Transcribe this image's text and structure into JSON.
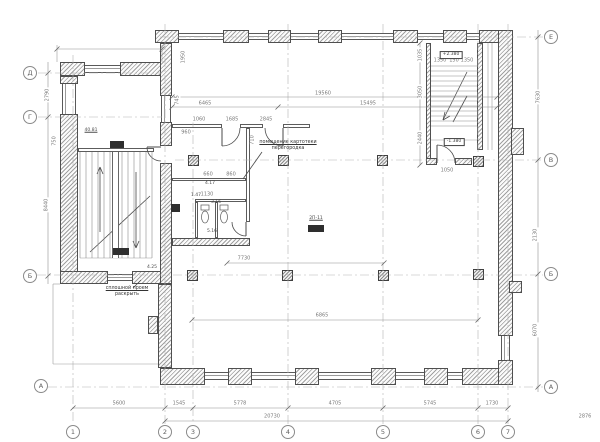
{
  "drawing_type": "architectural floor plan",
  "annotations": {
    "callout": {
      "line1": "помещение картотеки",
      "line2": "перегородка"
    },
    "opening_note": {
      "line1": "сплошной проем",
      "line2": "раскрыть"
    }
  },
  "colors": {
    "wall_line": "#4f4f4f",
    "hatch": "#a0a0a0",
    "dim_line": "#8f8f8f",
    "axis_line": "#b3b3b3",
    "dim_text": "#7a7a7a",
    "stamp": "#2e2e2e"
  },
  "plan": {
    "bubbles": [
      {
        "label": "Д",
        "x": 30,
        "y": 73
      },
      {
        "label": "Г",
        "x": 30,
        "y": 117
      },
      {
        "label": "Б",
        "x": 30,
        "y": 276
      },
      {
        "label": "А",
        "x": 41,
        "y": 386
      },
      {
        "label": "Е",
        "x": 551,
        "y": 37
      },
      {
        "label": "В",
        "x": 551,
        "y": 160
      },
      {
        "label": "Б",
        "x": 551,
        "y": 274
      },
      {
        "label": "А",
        "x": 551,
        "y": 387
      },
      {
        "label": "1",
        "x": 73,
        "y": 432
      },
      {
        "label": "2",
        "x": 165,
        "y": 432
      },
      {
        "label": "3",
        "x": 193,
        "y": 432
      },
      {
        "label": "4",
        "x": 288,
        "y": 432
      },
      {
        "label": "5",
        "x": 383,
        "y": 432
      },
      {
        "label": "6",
        "x": 478,
        "y": 432
      },
      {
        "label": "7",
        "x": 508,
        "y": 432
      }
    ],
    "walls": [
      [
        155,
        30,
        24,
        13
      ],
      [
        223,
        30,
        26,
        13
      ],
      [
        268,
        30,
        23,
        13
      ],
      [
        318,
        30,
        24,
        13
      ],
      [
        393,
        30,
        25,
        13
      ],
      [
        443,
        30,
        24,
        13
      ],
      [
        479,
        30,
        34,
        13
      ],
      [
        60,
        62,
        25,
        14
      ],
      [
        120,
        62,
        42,
        14
      ],
      [
        60,
        76,
        18,
        8
      ],
      [
        60,
        114,
        18,
        170
      ],
      [
        60,
        271,
        48,
        13
      ],
      [
        132,
        271,
        40,
        13
      ],
      [
        160,
        43,
        12,
        53
      ],
      [
        160,
        122,
        12,
        24
      ],
      [
        160,
        163,
        12,
        121
      ],
      [
        158,
        284,
        14,
        84
      ],
      [
        148,
        316,
        10,
        18
      ],
      [
        160,
        368,
        45,
        17
      ],
      [
        228,
        368,
        24,
        17
      ],
      [
        295,
        368,
        24,
        17
      ],
      [
        371,
        368,
        25,
        17
      ],
      [
        424,
        368,
        24,
        17
      ],
      [
        462,
        368,
        51,
        17
      ],
      [
        498,
        30,
        15,
        306
      ],
      [
        498,
        360,
        15,
        25
      ],
      [
        511,
        128,
        13,
        27
      ],
      [
        509,
        281,
        13,
        12
      ],
      [
        426,
        43,
        5,
        122
      ],
      [
        477,
        43,
        6,
        107
      ],
      [
        426,
        158,
        11,
        7
      ],
      [
        455,
        158,
        17,
        7
      ],
      [
        172,
        238,
        78,
        8
      ]
    ],
    "windows": [
      [
        179,
        33,
        44,
        7,
        "h"
      ],
      [
        249,
        33,
        19,
        7,
        "h"
      ],
      [
        291,
        33,
        27,
        7,
        "h"
      ],
      [
        342,
        33,
        51,
        7,
        "h"
      ],
      [
        418,
        33,
        25,
        7,
        "h"
      ],
      [
        467,
        33,
        12,
        7,
        "h"
      ],
      [
        85,
        65,
        35,
        8,
        "h"
      ],
      [
        62,
        84,
        14,
        30,
        "v"
      ],
      [
        161,
        96,
        10,
        26,
        "v"
      ],
      [
        108,
        274,
        24,
        7,
        "h"
      ],
      [
        205,
        372,
        23,
        8,
        "h"
      ],
      [
        252,
        372,
        43,
        8,
        "h"
      ],
      [
        319,
        372,
        52,
        8,
        "h"
      ],
      [
        396,
        372,
        28,
        8,
        "h"
      ],
      [
        448,
        372,
        14,
        8,
        "h"
      ],
      [
        501,
        336,
        9,
        24,
        "v"
      ]
    ],
    "partitions": [
      [
        172,
        124,
        50,
        4
      ],
      [
        240,
        124,
        23,
        4
      ],
      [
        283,
        124,
        27,
        4
      ],
      [
        246,
        128,
        4,
        94
      ],
      [
        172,
        178,
        74,
        3
      ],
      [
        195,
        199,
        51,
        3
      ],
      [
        215,
        202,
        3,
        36
      ],
      [
        195,
        202,
        3,
        36
      ],
      [
        78,
        148,
        76,
        4
      ]
    ],
    "columns": [
      [
        193,
        160
      ],
      [
        283,
        160
      ],
      [
        382,
        160
      ],
      [
        478,
        161
      ],
      [
        192,
        275
      ],
      [
        287,
        275
      ],
      [
        383,
        275
      ],
      [
        478,
        274
      ]
    ],
    "stamps": [
      [
        110,
        141,
        14,
        7
      ],
      [
        113,
        248,
        16,
        7
      ],
      [
        308,
        225,
        16,
        7
      ],
      [
        171,
        204,
        9,
        8
      ]
    ],
    "bands": [
      [
        112,
        152,
        7,
        106
      ]
    ],
    "level_labels": [
      {
        "t": "+2.380",
        "x": 451,
        "y": 55
      },
      {
        "t": "-1.380",
        "x": 454,
        "y": 142
      }
    ],
    "room_tags": [
      {
        "t": "40.81",
        "x": 91,
        "y": 131,
        "u": true
      },
      {
        "t": "2П-11",
        "x": 316,
        "y": 219,
        "u": true
      },
      {
        "t": "4.17",
        "x": 210,
        "y": 184,
        "u": false
      },
      {
        "t": "3.16",
        "x": 216,
        "y": 203,
        "u": false
      },
      {
        "t": "5.16",
        "x": 212,
        "y": 232,
        "u": false
      },
      {
        "t": "1.47",
        "x": 196,
        "y": 196,
        "u": false
      },
      {
        "t": "4.25",
        "x": 152,
        "y": 268,
        "u": false
      }
    ],
    "dim_texts": [
      {
        "t": "19560",
        "x": 323,
        "y": 94,
        "r": 0
      },
      {
        "t": "6465",
        "x": 205,
        "y": 104,
        "r": 0
      },
      {
        "t": "15495",
        "x": 368,
        "y": 104,
        "r": 0
      },
      {
        "t": "1950",
        "x": 184,
        "y": 57,
        "r": -90
      },
      {
        "t": "745",
        "x": 178,
        "y": 100,
        "r": -90
      },
      {
        "t": "2790",
        "x": 48,
        "y": 95,
        "r": -90
      },
      {
        "t": "750",
        "x": 55,
        "y": 141,
        "r": -90
      },
      {
        "t": "8440",
        "x": 47,
        "y": 205,
        "r": -90
      },
      {
        "t": "7630",
        "x": 539,
        "y": 97,
        "r": -90
      },
      {
        "t": "2130",
        "x": 536,
        "y": 235,
        "r": -90
      },
      {
        "t": "6070",
        "x": 536,
        "y": 330,
        "r": -90
      },
      {
        "t": "5600",
        "x": 119,
        "y": 404,
        "r": 0
      },
      {
        "t": "1545",
        "x": 179,
        "y": 404,
        "r": 0
      },
      {
        "t": "5778",
        "x": 240,
        "y": 404,
        "r": 0
      },
      {
        "t": "4705",
        "x": 335,
        "y": 404,
        "r": 0
      },
      {
        "t": "5745",
        "x": 430,
        "y": 404,
        "r": 0
      },
      {
        "t": "1730",
        "x": 492,
        "y": 404,
        "r": 0
      },
      {
        "t": "20730",
        "x": 272,
        "y": 417,
        "r": 0
      },
      {
        "t": "2876",
        "x": 585,
        "y": 417,
        "r": 0
      },
      {
        "t": "7730",
        "x": 244,
        "y": 259,
        "r": 0
      },
      {
        "t": "6865",
        "x": 322,
        "y": 316,
        "r": 0
      },
      {
        "t": "1350",
        "x": 440,
        "y": 61,
        "r": 0
      },
      {
        "t": "150",
        "x": 454,
        "y": 61,
        "r": 0
      },
      {
        "t": "1350",
        "x": 467,
        "y": 61,
        "r": 0
      },
      {
        "t": "1035",
        "x": 421,
        "y": 55,
        "r": -90
      },
      {
        "t": "3050",
        "x": 421,
        "y": 92,
        "r": -90
      },
      {
        "t": "2440",
        "x": 421,
        "y": 138,
        "r": -90
      },
      {
        "t": "1050",
        "x": 447,
        "y": 171,
        "r": 0
      },
      {
        "t": "960",
        "x": 186,
        "y": 133,
        "r": 0
      },
      {
        "t": "1060",
        "x": 199,
        "y": 120,
        "r": 0
      },
      {
        "t": "1685",
        "x": 232,
        "y": 120,
        "r": 0
      },
      {
        "t": "2845",
        "x": 266,
        "y": 120,
        "r": 0
      },
      {
        "t": "660",
        "x": 208,
        "y": 175,
        "r": 0
      },
      {
        "t": "860",
        "x": 231,
        "y": 175,
        "r": 0
      },
      {
        "t": "1130",
        "x": 207,
        "y": 195,
        "r": 0
      },
      {
        "t": "710",
        "x": 253,
        "y": 140,
        "r": -90
      }
    ],
    "svg": {
      "axis": [
        [
          73,
          55,
          73,
          424
        ],
        [
          165,
          24,
          165,
          424
        ],
        [
          193,
          118,
          193,
          424
        ],
        [
          288,
          24,
          288,
          424
        ],
        [
          383,
          24,
          383,
          424
        ],
        [
          478,
          24,
          478,
          424
        ],
        [
          508,
          24,
          508,
          424
        ],
        [
          160,
          37,
          543,
          37
        ],
        [
          38,
          73,
          162,
          73
        ],
        [
          38,
          117,
          162,
          117
        ],
        [
          175,
          160,
          543,
          160
        ],
        [
          37,
          275,
          543,
          275
        ],
        [
          48,
          387,
          543,
          387
        ]
      ],
      "dim": [
        [
          172,
          97,
          497,
          97
        ],
        [
          172,
          107,
          497,
          107
        ],
        [
          73,
          408,
          508,
          408
        ],
        [
          165,
          421,
          508,
          421
        ],
        [
          48,
          62,
          48,
          284
        ],
        [
          538,
          30,
          538,
          392
        ],
        [
          227,
          263,
          384,
          263
        ],
        [
          192,
          320,
          478,
          320
        ],
        [
          57,
          49,
          162,
          49
        ],
        [
          420,
          43,
          420,
          165
        ]
      ],
      "thin": [
        [
          53,
          284,
          53,
          364
        ],
        [
          53,
          364,
          158,
          364
        ],
        [
          53,
          284,
          60,
          284
        ],
        [
          488,
          43,
          488,
          150
        ],
        [
          492,
          43,
          492,
          150
        ],
        [
          57,
          45,
          57,
          62
        ],
        [
          162,
          45,
          162,
          62
        ],
        [
          431,
          140,
          477,
          140
        ],
        [
          80,
          258,
          152,
          258
        ]
      ],
      "lead": [
        [
          262,
          152,
          243,
          179
        ],
        [
          133,
          288,
          141,
          280
        ],
        [
          100,
          232,
          100,
          167
        ],
        [
          97,
          174,
          100,
          167
        ],
        [
          103,
          174,
          100,
          167
        ],
        [
          136,
          172,
          136,
          248
        ],
        [
          133,
          241,
          136,
          248
        ],
        [
          139,
          241,
          136,
          248
        ],
        [
          90,
          252,
          150,
          196
        ],
        [
          467,
          72,
          443,
          120
        ],
        [
          445,
          112,
          443,
          120
        ],
        [
          450,
          116,
          443,
          120
        ],
        [
          467,
          96,
          453,
          122
        ]
      ],
      "ticks": [
        [
          73,
          408
        ],
        [
          165,
          408
        ],
        [
          193,
          408
        ],
        [
          288,
          408
        ],
        [
          383,
          408
        ],
        [
          478,
          408
        ],
        [
          508,
          408
        ],
        [
          165,
          421
        ],
        [
          508,
          421
        ],
        [
          172,
          97
        ],
        [
          497,
          97
        ],
        [
          172,
          107
        ],
        [
          278,
          107
        ],
        [
          497,
          107
        ],
        [
          227,
          263
        ],
        [
          384,
          263
        ],
        [
          192,
          320
        ],
        [
          478,
          320
        ],
        [
          57,
          49
        ],
        [
          162,
          49
        ],
        [
          48,
          73
        ],
        [
          48,
          117
        ],
        [
          48,
          276
        ],
        [
          538,
          37
        ],
        [
          538,
          160
        ],
        [
          538,
          274
        ],
        [
          538,
          387
        ],
        [
          420,
          43
        ],
        [
          420,
          165
        ]
      ],
      "arcs": [
        "M240,128 A18,18 0 0 1 222,146",
        "M265,128 A18,18 0 0 0 283,146",
        "M232,222 A14,14 0 0 0 246,236",
        "M437,145 A18,18 0 0 1 455,163",
        "M147,147 A14,14 0 0 0 161,161"
      ],
      "leafs": [
        [
          222,
          128,
          222,
          146
        ],
        [
          283,
          128,
          283,
          146
        ],
        [
          246,
          222,
          246,
          236
        ],
        [
          437,
          163,
          437,
          145
        ],
        [
          161,
          147,
          147,
          147
        ]
      ],
      "treads": [
        {
          "orient": "v",
          "from": 80,
          "to": 152,
          "step": 6,
          "a": 152,
          "b": 258
        },
        {
          "orient": "h",
          "from": 66,
          "to": 130,
          "step": 5,
          "a": 431,
          "b": 477
        }
      ],
      "fixtures": {
        "toilets": [
          {
            "tank": [
              201,
              205,
              8,
              5
            ],
            "bowl": [
              205,
              217,
              3.5,
              6
            ]
          },
          {
            "tank": [
              220,
              205,
              8,
              5
            ],
            "bowl": [
              224,
              217,
              3.5,
              6
            ]
          }
        ]
      }
    }
  }
}
